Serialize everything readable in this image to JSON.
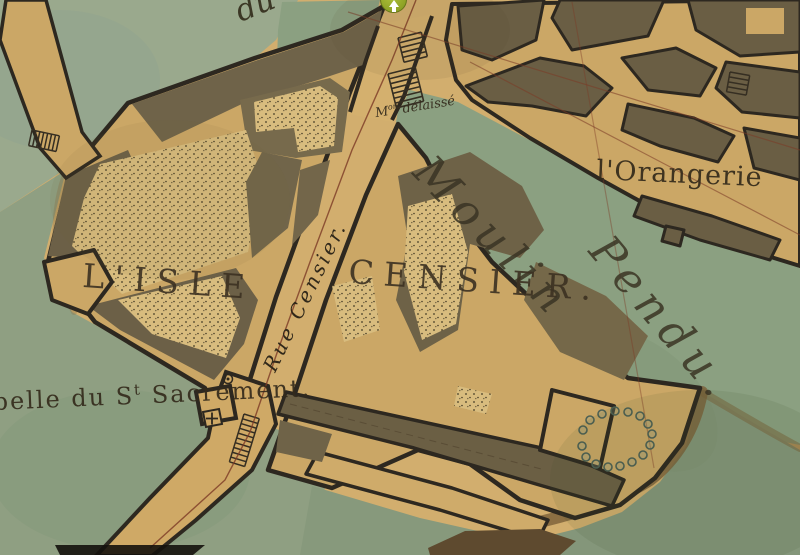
{
  "labels": {
    "top_street_fragment": "du",
    "abandoned_mill": {
      "prefix": "M",
      "sup": "on",
      "rest": " délaissé"
    },
    "river_word1": "Moulin",
    "river_word2": "Pendu.",
    "orangerie": "l'Orangerie",
    "island": "L'ISLE",
    "block": "CENSIER.",
    "street": "Rue Censier.",
    "chapel": {
      "prefix": "belle du S",
      "sup": "t",
      "rest": " Sacrement."
    }
  },
  "marker": {
    "name": "location-marker",
    "direction": "up"
  },
  "colors": {
    "paper_tan": "#d2ae6e",
    "block_tan": "#cba766",
    "stipple_tan": "#d8bc7e",
    "building_olive": "#6f6348",
    "outline_dark": "#2d2820",
    "water_green": "#8ba081",
    "water_light": "#9aa98d",
    "shore_brown": "#7a5f38",
    "survey_red": "#7c3a26",
    "marker_green": "#8ea226",
    "text_ink": "#352b1b"
  }
}
